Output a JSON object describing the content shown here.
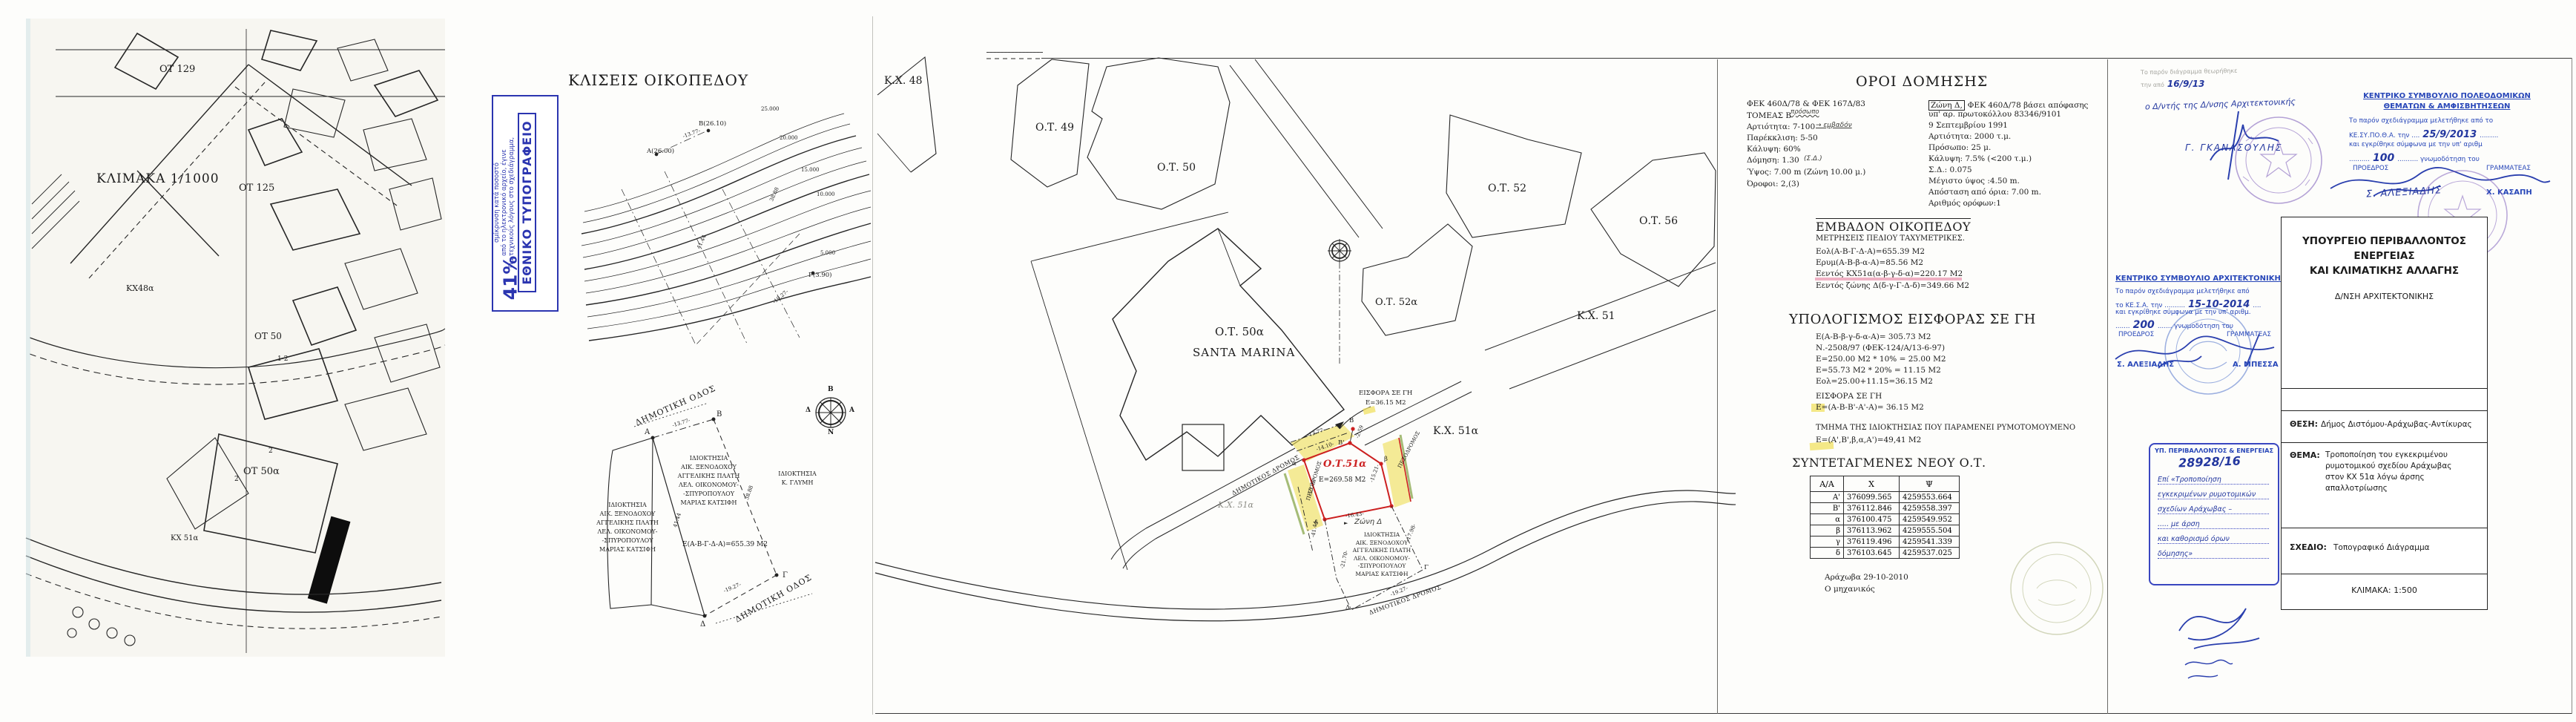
{
  "colors": {
    "accent_red": "#cc2020",
    "highlight_yellow": "#efe070",
    "highlight_pink": "#e87fa0",
    "stamp_blue": "#2746b8",
    "print_stamp_blue": "#2b35b0",
    "pencil_grey": "#8d8d86"
  },
  "compass": {
    "n": "Β",
    "e": "Α",
    "s": "Ν",
    "w": "Δ"
  },
  "owners": [
    "ΙΔΙΟΚΤΗΣΙΑ",
    "ΑΙΚ. ΞΕΝΟΔΟΧΟΥ",
    "ΑΓΓΕΛΙΚΗΣ ΠΛΑΤΗ",
    "ΛΕΛ. ΟΙΚΟΝΟΜΟΥ-",
    "-ΣΠΥΡΟΠΟΥΛΟΥ",
    "ΜΑΡΙΑΣ ΚΑΤΣΙΦΗ"
  ],
  "map_panel": {
    "labels": {
      "ot129": "ΟΤ 129",
      "ot125": "ΟΤ 125",
      "scale": "ΚΛΙΜΑΚΑ 1/1000",
      "kx48a": "ΚΧ48α",
      "ot50": "ΟΤ 50",
      "n12": "1-2",
      "n2a": "2",
      "n2b": "2",
      "ot50a": "ΟΤ 50α",
      "kx51a": "ΚΧ 51α"
    }
  },
  "print_stamp": {
    "title": "ΕΘΝΙΚΟ ΤΥΠΟΓΡΑΦΕΙΟ",
    "line1": "Για τεχνικούς λόγους στο σχεδιάγραμμα,",
    "line2": "από το ηλεκτρονικό αρχείο, έγινε",
    "line3": "σμίκρυνση κατά ποσοστό",
    "percent": "41%"
  },
  "slopes": {
    "title": "ΚΛΙΣΕΙΣ ΟΙΚΟΠΕΔΟΥ",
    "contour_labels": [
      "25.000",
      "20.000",
      "15.000",
      "10.000",
      "5.000"
    ],
    "pt_a": "Α(26.00)",
    "pt_b": "Β(26.10)",
    "pt_g": "Γ(3.90)",
    "d_ab": "-13.77-",
    "d_bg": "38.88",
    "d_ad": "41.44",
    "d_gd": "-19.27-"
  },
  "plot_diagram": {
    "road_top": "ΔΗΜΟΤΙΚΗ ΟΔΟΣ",
    "road_bottom": "ΔΗΜΟΤΙΚΗ ΟΔΟΣ",
    "pt_a": "Α",
    "pt_b": "Β",
    "pt_g": "Γ",
    "pt_d": "Δ",
    "d_ab": "-13.77-",
    "d_bg": "38.88",
    "d_ad": "41.44",
    "d_gd": "-19.27-",
    "owner_right": [
      "ΙΔΙΟΚΤΗΣΙΑ",
      "Κ. ΓΛΥΜΗ"
    ],
    "area": "Ε(Α-Β-Γ-Δ-Α)=655.39 Μ2"
  },
  "site_plan": {
    "kx48": "Κ.Χ. 48",
    "ot49": "Ο.Τ. 49",
    "ot50": "Ο.Τ. 50",
    "ot50a": "Ο.Τ. 50α",
    "santa": "SANTA MARINA",
    "ot52": "Ο.Τ. 52",
    "ot52a": "Ο.Τ. 52α",
    "ot56": "Ο.Τ. 56",
    "kx51": "Κ.Χ. 51",
    "kx51a_big": "Κ.Χ. 51α",
    "kx51a_pencil": "Κ.Χ. 51α",
    "eisfora1": "ΕΙΣΦΟΡΑ ΣΕ ΓΗ",
    "eisfora2": "Ε=36.15 Μ2",
    "new_ot": "Ο.Τ.51α",
    "new_ot_area": "Ε=269.58 Μ2",
    "road1": "ΔΗΜΟΤΙΚΟΣ ΔΡΟΜΟΣ",
    "road2": "ΔΗΜΟΤΙΚΟΣ ΔΡΟΜΟΣ",
    "ped1": "ΠΕΖΟΔΡΟΜΟΣ",
    "ped2": "ΠΕΖΟΔΡΟΜΟΣ",
    "zone_marker": "►",
    "zone_note": "Ζώνη Δ",
    "dims": {
      "ab": "-13.77-",
      "ab2": "-14.10-",
      "b2": "-2.59",
      "left": "-13.31-",
      "right": "-15.21-",
      "bottom": "-16.43-",
      "d4144": "-41.44-",
      "d1798": "-17.98-",
      "d2170": "-21.70-",
      "d1927": "-19.27-"
    },
    "pts": {
      "B": "Β",
      "B2": "Β'",
      "b": "β",
      "G": "Γ",
      "D": "Δ",
      "d": "δ",
      "a": "α"
    }
  },
  "terms": {
    "title": "ΟΡΟΙ ΔΟΜΗΣΗΣ",
    "left": [
      "ΦΕΚ 460Δ/78 & ΦΕΚ 167Δ/83",
      "ΤΟΜΕΑΣ Β",
      "Αρτιότητα: 7-100",
      "Παρέκκλιση: 5-50",
      "Κάλυψη: 60%",
      "Δόμηση: 1.30",
      "Ύψος: 7.00 m (Ζώνη 10.00 μ.)",
      "Όροφοι: 2,(3)"
    ],
    "hand_prosopo": "πρόσωπο",
    "hand_emvadon": "→ εμβαδόν",
    "hand_sd": "(Σ.Δ.)",
    "zone_box": "Ζώνη Δ,",
    "right": [
      "ΦΕΚ 460Δ/78 βάσει απόφασης",
      "υπ' αρ. πρωτοκόλλου  83346/9101",
      "9 Σεπτεμβρίου 1991",
      "Αρτιότητα: 2000 τ.μ.",
      "Πρόσωπο: 25 μ.",
      "Κάλυψη: 7.5% (<200 τ.μ.)",
      "Σ.Δ.: 0.075",
      "Μέγιστο ύψος :4.50 m.",
      "Απόσταση από όρια: 7.00 m.",
      "Αριθμός ορόφων:1"
    ],
    "area_title": "ΕΜΒΑΔΟΝ ΟΙΚΟΠΕΔΟΥ",
    "area_sub": "ΜΕΤΡΗΣΕΙΣ ΠΕΔΙΟΥ ΤΑΧΥΜΕΤΡΙΚΕΣ.",
    "area_lines": [
      "Εολ(Α-Β-Γ-Δ-Α)=655.39 Μ2",
      "Ερυμ(Α-Β-β-α-Α)=85.56 Μ2",
      "Εεντός ΚΧ51α(α-β-γ-δ-α)=220.17 Μ2",
      "Εεντός ζώνης Δ(δ-γ-Γ-Δ-δ)=349.66 Μ2"
    ],
    "calc_title": "ΥΠΟΛΟΓΙΣΜΟΣ ΕΙΣΦΟΡΑΣ ΣΕ ΓΗ",
    "calc_lines": [
      "Ε(Α-Β-β-γ-δ-α-Α)= 305.73 Μ2",
      "Ν.-2508/97 (ΦΕΚ-124/Α/13-6-97)",
      "Ε=250.00 Μ2 * 10% = 25.00 Μ2",
      "Ε=55.73 Μ2 * 20% = 11.15 Μ2",
      "Εολ=25.00+11.15=36.15 Μ2"
    ],
    "eisfora_head": "ΕΙΣΦΟΡΑ ΣΕ ΓΗ",
    "eisfora_line": "Ε=(Α-Β-Β'-Α'-Α)= 36.15 Μ2",
    "remnant_head": "ΤΜΗΜΑ ΤΗΣ ΙΔΙΟΚΤΗΣΙΑΣ ΠΟΥ ΠΑΡΑΜΕΝΕΙ ΡΥΜΟΤΟΜΟΥΜΕΝΟ",
    "remnant_line": "Ε=(Α',Β',β,α,Α')=49,41 Μ2",
    "coords_title": "ΣΥΝΤΕΤΑΓΜΕΝΕΣ ΝΕΟΥ Ο.Τ.",
    "coords_headers": [
      "Α/Α",
      "Χ",
      "Ψ"
    ],
    "coords_rows": [
      [
        "Α'",
        "376099.565",
        "4259553.664"
      ],
      [
        "Β'",
        "376112.846",
        "4259558.397"
      ],
      [
        "α",
        "376100.475",
        "4259549.952"
      ],
      [
        "β",
        "376113.962",
        "4259555.504"
      ],
      [
        "γ",
        "376119.496",
        "4259541.339"
      ],
      [
        "δ",
        "376103.645",
        "4259537.025"
      ]
    ],
    "place_date": "Αράχωβα 29-10-2010",
    "engineer": "Ο μηχανικός"
  },
  "approvals": {
    "note_pre": "Το παρόν διάγραμμα θεωρήθηκε",
    "note_mid": "την από",
    "note_date": "16/9/13",
    "note_dir": "ο Δ/ντής της Δ/νσης Αρχιτεκτονικής",
    "sig1_name": "Γ. ΓΚΑΝΑΣΟΥΛΗΣ",
    "kesa": {
      "title": "ΚΕΝΤΡΙΚΟ ΣΥΜΒΟΥΛΙΟ ΑΡΧΙΤΕΚΤΟΝΙΚΗΣ",
      "l1": "Το παρόν σχεδιάγραμμα μελετήθηκε από",
      "l2a": "το ΚΕ.Σ.Α. την ..........",
      "l2b": "15-10-2014",
      "l2c": "....",
      "l3": "και εγκρίθηκε σύμφωνα με την υπ' αριθμ.",
      "l4a": ".......",
      "l4b": "200",
      "l4c": "....... γνωμοδότηση του",
      "proedros": "ΠΡΟΕΔΡΟΣ",
      "grammateas": "ΓΡΑΜΜΑΤΕΑΣ",
      "name_l": "Σ. ΑΛΕΞΙΑΔΗΣ",
      "name_r": "Α. ΜΠΕΣΣΑ"
    },
    "kesypotha": {
      "title1": "ΚΕΝΤΡΙΚΟ ΣΥΜΒΟΥΛΙΟ ΠΟΛΕΟΔΟΜΙΚΩΝ",
      "title2": "ΘΕΜΑΤΩΝ & ΑΜΦΙΣΒΗΤΗΣΕΩΝ",
      "l1": "Το παρόν σχεδιάγραμμα μελετήθηκε από το",
      "l2a": "ΚΕ.ΣΥ.ΠΟ.Θ.Α. την ....",
      "l2b": "25/9/2013",
      "l2c": ".........",
      "l3": "και εγκρίθηκε σύμφωνα με την υπ' αριθμ",
      "l4a": "..........",
      "l4b": "100",
      "l4c": ".......... γνωμοδότηση του",
      "proedros": "ΠΡΟΕΔΡΟΣ",
      "grammateas": "ΓΡΑΜΜΑΤΕΑΣ",
      "name_l": "Σ. ΑΛΕΞΙΑΔΗΣ",
      "name_r": "Χ. ΚΑΣΑΠΗ"
    },
    "ypen_box": {
      "header": "ΥΠ. ΠΕΡΙΒΑΛΛΟΝΤΟΣ & ΕΝΕΡΓΕΙΑΣ",
      "protocol": "28928/16",
      "hand_lines": [
        "Επί «Τροποποίηση",
        "εγκεκριμένων ρυμοτομικών",
        "σχεδίων Αράχωβας –",
        "..... με άρση",
        "και καθορισμό όρων",
        "δόμησης»"
      ]
    }
  },
  "title_block": {
    "ministry": [
      "ΥΠΟΥΡΓΕΙΟ ΠΕΡΙΒΑΛΛΟΝΤΟΣ",
      "ΕΝΕΡΓΕΙΑΣ",
      "ΚΑΙ ΚΛΙΜΑΤΙΚΗΣ ΑΛΛΑΓΗΣ"
    ],
    "dept": "Δ/ΝΣΗ ΑΡΧΙΤΕΚΤΟΝΙΚΗΣ",
    "thesi_label": "ΘΕΣΗ:",
    "thesi": "Δήμος Διστόμου-Αράχωβας-Αντίκυρας",
    "thema_label": "ΘΕΜΑ:",
    "thema_lines": [
      "Τροποποίηση του εγκεκριμένου",
      "ρυμοτομικού σχεδίου Αράχωβας",
      "στον ΚΧ 51α λόγω άρσης",
      "απαλλοτρίωσης"
    ],
    "sxedio_label": "ΣΧΕΔΙΟ:",
    "sxedio": "Τοπογραφικό Διάγραμμα",
    "klimaka": "ΚΛΙΜΑΚΑ: 1:500"
  }
}
